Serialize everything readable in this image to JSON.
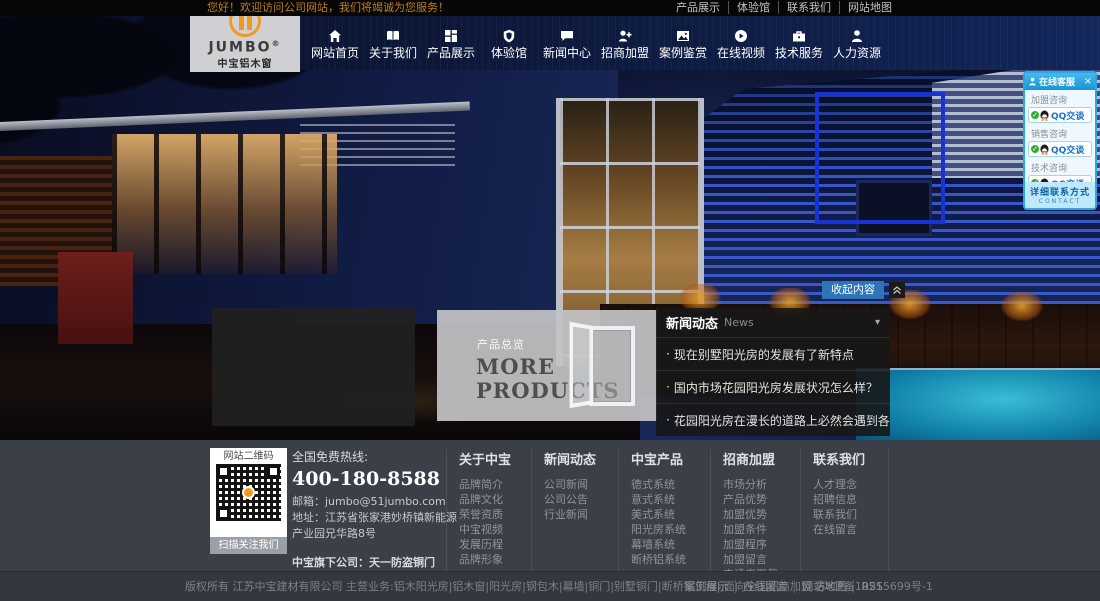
{
  "topbar": {
    "welcome": "您好！欢迎访问公司网站，我们将竭诚为您服务！",
    "links": [
      "产品展示",
      "体验馆",
      "联系我们",
      "网站地图"
    ]
  },
  "logo": {
    "brand": "JUMBO",
    "registered": "®",
    "name": "中宝铝木窗"
  },
  "nav": {
    "items": [
      {
        "label": "网站首页",
        "icon": "home-icon"
      },
      {
        "label": "关于我们",
        "icon": "book-icon"
      },
      {
        "label": "产品展示",
        "icon": "grid-icon"
      },
      {
        "label": "体验馆",
        "icon": "shield-icon"
      },
      {
        "label": "新闻中心",
        "icon": "chat-icon"
      },
      {
        "label": "招商加盟",
        "icon": "user-plus-icon"
      },
      {
        "label": "案例鉴赏",
        "icon": "photo-icon"
      },
      {
        "label": "在线视频",
        "icon": "play-icon"
      },
      {
        "label": "技术服务",
        "icon": "briefcase-icon"
      },
      {
        "label": "人力资源",
        "icon": "user-icon"
      }
    ]
  },
  "qq_panel": {
    "title": "在线客服",
    "close": "×",
    "check": "✓",
    "groups": [
      {
        "label": "加盟咨询",
        "button": "QQ交谈"
      },
      {
        "label": "销售咨询",
        "button": "QQ交谈"
      },
      {
        "label": "技术咨询",
        "button": "QQ交谈"
      }
    ],
    "contact_label": "详细联系方式",
    "contact_sub": "CONTACT"
  },
  "hero": {
    "collapse_button": "收起内容"
  },
  "products_overlay": {
    "tag": "产品总览",
    "line1": "MORE",
    "line2": "PRODUCTS"
  },
  "news_panel": {
    "title": "新闻动态",
    "subtitle": "News",
    "caret": "▾",
    "items": [
      "现在别墅阳光房的发展有了新特点",
      "国内市场花园阳光房发展状况怎么样？",
      "花园阳光房在漫长的道路上必然会遇到各种挑战"
    ]
  },
  "footer": {
    "qr": {
      "top": "网站二维码",
      "bottom": "扫描关注我们"
    },
    "contact": {
      "hotline_label": "全国免费热线:",
      "phone": "400-180-8588",
      "email_line": "邮箱：jumbo@51jumbo.com",
      "address_line": "地址：江苏省张家港妙桥镇新能源产业园兄华路8号",
      "subsidiary": "中宝旗下公司：天一防盗铜门"
    },
    "columns": [
      {
        "title": "关于中宝",
        "links": [
          "品牌简介",
          "品牌文化",
          "荣誉资质",
          "中宝视频",
          "发展历程",
          "品牌形象"
        ]
      },
      {
        "title": "新闻动态",
        "links": [
          "公司新闻",
          "公司公告",
          "行业新闻"
        ]
      },
      {
        "title": "中宝产品",
        "links": [
          "德式系统",
          "意式系统",
          "美式系统",
          "阳光房系统",
          "幕墙系统",
          "断桥铝系统"
        ]
      },
      {
        "title": "招商加盟",
        "links": [
          "市场分析",
          "产品优势",
          "加盟优势",
          "加盟条件",
          "加盟程序",
          "加盟留言",
          "申请表下载"
        ]
      },
      {
        "title": "联系我们",
        "links": [
          "人才理念",
          "招聘信息",
          "联系我们",
          "在线留言"
        ]
      }
    ]
  },
  "bottombar": {
    "copyright": "版权所有 江苏中宝建材有限公司 主营业务:铝木阳光房|铝木窗|阳光房|钢包木|幕墙|铜门|别墅铜门|断桥铝工程|.面向全国招商加盟 苏ICP备10215699号-1",
    "links": [
      "案例展示",
      "在线留言",
      "网站地图",
      "RSS"
    ]
  }
}
